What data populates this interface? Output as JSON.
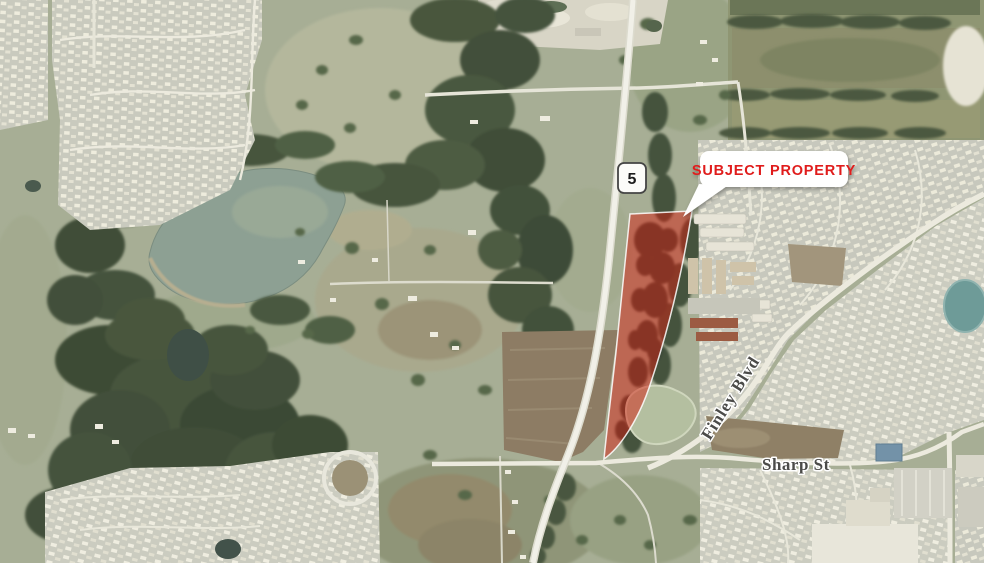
{
  "callout": {
    "label": "SUBJECT PROPERTY",
    "text_color": "#e01e1c",
    "bg_color": "#ffffff"
  },
  "highway_shield": {
    "route_number": "5"
  },
  "street_labels": {
    "finley": "Finley Blvd",
    "sharp": "Sharp St"
  },
  "subject_property": {
    "fill_color": "#d32011",
    "fill_opacity": "0.5",
    "outline_color": "#ffffff"
  }
}
